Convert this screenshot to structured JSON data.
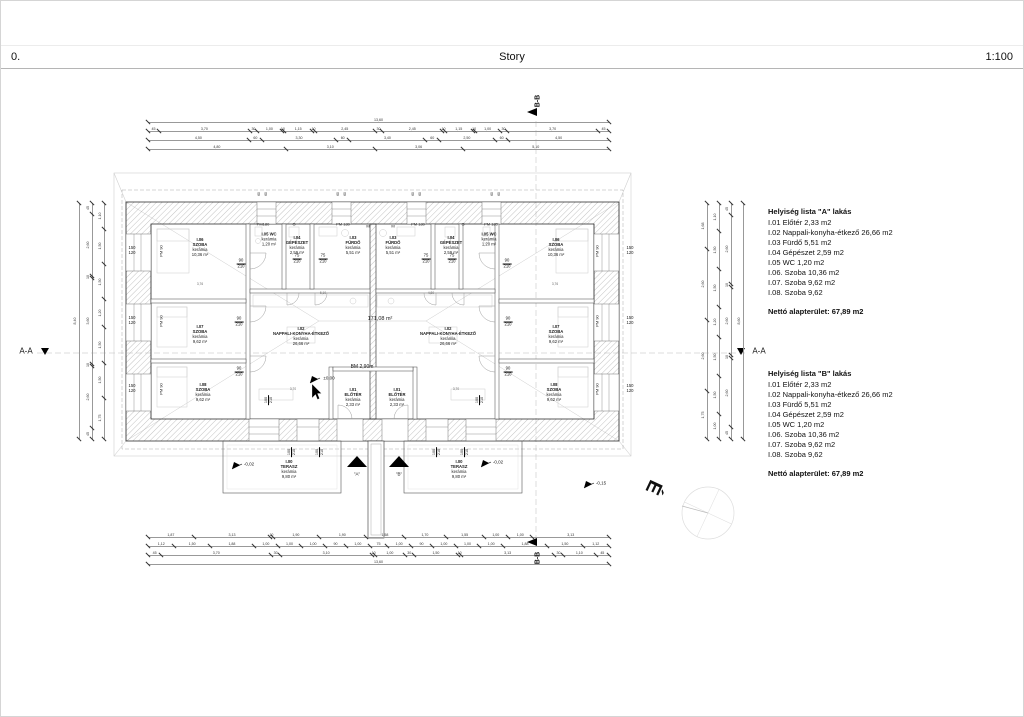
{
  "header": {
    "left": "0.",
    "center": "Story",
    "right": "1:100"
  },
  "section_markers": {
    "aa": "A-A",
    "bb": "B-B",
    "entrance_a": "\"A\"",
    "entrance_b": "\"B\"",
    "north": "É"
  },
  "room_lists": {
    "a": {
      "title": "Helyiség lista \"A\" lakás",
      "items": [
        "I.01 Előtér 2,33 m2",
        "I.02 Nappali-konyha-étkező 26,66 m2",
        "I.03 Fürdő 5,51 m2",
        "I.04 Gépészet 2,59 m2",
        "I.05 WC 1,20 m2",
        "I.06. Szoba 10,36 m2",
        "I.07. Szoba 9,62 m2",
        "I.08. Szoba 9,62"
      ],
      "total": "Nettó alapterület: 67,89 m2"
    },
    "b": {
      "title": "Helyiség lista \"B\" lakás",
      "items": [
        "I.01 Előtér 2,33 m2",
        "I.02 Nappali-konyha-étkező 26,66 m2",
        "I.03 Fürdő 5,51 m2",
        "I.04 Gépészet 2,59 m2",
        "I.05 WC 1,20 m2",
        "I.06. Szoba 10,36 m2",
        "I.07. Szoba 9,62 m2",
        "I.08. Szoba 9,62"
      ],
      "total": "Nettó alapterület: 67,89 m2"
    }
  },
  "plan": {
    "labels": [
      {
        "t": "I.06\nSZOBA\nkerámia\n10,36 m²",
        "x": 199,
        "y": 247,
        "hb": 2
      },
      {
        "t": "I.07\nSZOBA\nkerámia\n9,62 m²",
        "x": 199,
        "y": 334,
        "hb": 2
      },
      {
        "t": "I.08\nSZOBA\nkerámia\n9,62 m²",
        "x": 202,
        "y": 392,
        "hb": 2
      },
      {
        "t": "I.05 WC\nkerámia\n1,20 m²",
        "x": 268,
        "y": 239,
        "hb": 1
      },
      {
        "t": "I.04\nGÉPÉSZET\nkerámia\n2,59 m²",
        "x": 296,
        "y": 245,
        "hb": 2
      },
      {
        "t": "I.03\nFÜRDŐ\nkerámia\n5,51 m²",
        "x": 352,
        "y": 245,
        "hb": 2
      },
      {
        "t": "I.02\nNAPPALI-KONYHA-ÉTKEZŐ\nkerámia\n26,66 m²",
        "x": 300,
        "y": 336,
        "hb": 2
      },
      {
        "t": "I.01\nELŐTÉR\nkerámia\n2,33 m²",
        "x": 352,
        "y": 397,
        "hb": 2
      },
      {
        "t": "I.00\nTERASZ\nkerámia\n9,80 m²",
        "x": 288,
        "y": 469,
        "hb": 2
      },
      {
        "t": "I.03\nFÜRDŐ\nkerámia\n5,51 m²",
        "x": 392,
        "y": 245,
        "hb": 2
      },
      {
        "t": "I.04\nGÉPÉSZET\nkerámia\n2,59 m²",
        "x": 450,
        "y": 245,
        "hb": 2
      },
      {
        "t": "I.05 WC\nkerámia\n1,20 m²",
        "x": 488,
        "y": 239,
        "hb": 1
      },
      {
        "t": "I.06\nSZOBA\nkerámia\n10,36 m²",
        "x": 555,
        "y": 247,
        "hb": 2
      },
      {
        "t": "I.02\nNAPPALI-KONYHA-ÉTKEZŐ\nkerámia\n26,66 m²",
        "x": 447,
        "y": 336,
        "hb": 2
      },
      {
        "t": "I.07\nSZOBA\nkerámia\n9,62 m²",
        "x": 555,
        "y": 334,
        "hb": 2
      },
      {
        "t": "I.08\nSZOBA\nkerámia\n9,62 m²",
        "x": 553,
        "y": 392,
        "hb": 2
      },
      {
        "t": "I.01\nELŐTÉR\nkerámia\n2,33 m²",
        "x": 396,
        "y": 397,
        "hb": 2
      },
      {
        "t": "I.00\nTERASZ\nkerámia\n9,80 m²",
        "x": 458,
        "y": 469,
        "hb": 2
      },
      {
        "t": "171,08 m²",
        "x": 379,
        "y": 318,
        "fs": 5.5
      },
      {
        "t": "BM 2,90m",
        "x": 361,
        "y": 367,
        "fs": 5
      },
      {
        "t": "±0,00",
        "x": 328,
        "y": 377,
        "fs": 4.5
      },
      {
        "t": "-0,02",
        "x": 248,
        "y": 463,
        "fs": 4.5
      },
      {
        "t": "-0,02",
        "x": 497,
        "y": 461,
        "fs": 4.5
      },
      {
        "t": "-0,15",
        "x": 600,
        "y": 482,
        "fs": 4.5
      },
      {
        "t": "150\n120",
        "x": 131,
        "y": 250
      },
      {
        "t": "150\n120",
        "x": 131,
        "y": 320
      },
      {
        "t": "150\n120",
        "x": 131,
        "y": 388
      },
      {
        "t": "150\n120",
        "x": 629,
        "y": 250
      },
      {
        "t": "150\n120",
        "x": 629,
        "y": 320
      },
      {
        "t": "150\n120",
        "x": 629,
        "y": 388
      },
      {
        "t": "PM 90",
        "x": 161,
        "y": 250,
        "fs": 4,
        "rot": -90
      },
      {
        "t": "PM 90",
        "x": 161,
        "y": 320,
        "fs": 4,
        "rot": -90
      },
      {
        "t": "PM 90",
        "x": 161,
        "y": 388,
        "fs": 4,
        "rot": -90
      },
      {
        "t": "PM 90",
        "x": 597,
        "y": 250,
        "fs": 4,
        "rot": -90
      },
      {
        "t": "PM 90",
        "x": 597,
        "y": 320,
        "fs": 4,
        "rot": -90
      },
      {
        "t": "PM 90",
        "x": 597,
        "y": 388,
        "fs": 4,
        "rot": -90
      },
      {
        "t": "PM180",
        "x": 262,
        "y": 224,
        "fs": 4
      },
      {
        "t": "G",
        "x": 293,
        "y": 224,
        "fs": 4
      },
      {
        "t": "PM 180",
        "x": 342,
        "y": 224,
        "fs": 4
      },
      {
        "t": "M",
        "x": 367,
        "y": 226,
        "fs": 4
      },
      {
        "t": "M",
        "x": 392,
        "y": 226,
        "fs": 4
      },
      {
        "t": "PM 180",
        "x": 417,
        "y": 224,
        "fs": 4
      },
      {
        "t": "G",
        "x": 462,
        "y": 224,
        "fs": 4
      },
      {
        "t": "PM 180",
        "x": 490,
        "y": 224,
        "fs": 4
      },
      {
        "t": "60",
        "x": 259,
        "y": 193,
        "fs": 3.2,
        "rot": -90
      },
      {
        "t": "60",
        "x": 266,
        "y": 193,
        "fs": 3.2,
        "rot": -90
      },
      {
        "t": "60",
        "x": 338,
        "y": 193,
        "fs": 3.2,
        "rot": -90
      },
      {
        "t": "60",
        "x": 345,
        "y": 193,
        "fs": 3.2,
        "rot": -90
      },
      {
        "t": "60",
        "x": 413,
        "y": 193,
        "fs": 3.2,
        "rot": -90
      },
      {
        "t": "60",
        "x": 420,
        "y": 193,
        "fs": 3.2,
        "rot": -90
      },
      {
        "t": "60",
        "x": 492,
        "y": 193,
        "fs": 3.2,
        "rot": -90
      },
      {
        "t": "60",
        "x": 499,
        "y": 193,
        "fs": 3.2,
        "rot": -90
      },
      {
        "t": "90\n210",
        "x": 240,
        "y": 263,
        "u": true
      },
      {
        "t": "90\n210",
        "x": 238,
        "y": 321,
        "u": true
      },
      {
        "t": "90\n210",
        "x": 238,
        "y": 371,
        "u": true
      },
      {
        "t": "90\n210",
        "x": 506,
        "y": 263,
        "u": true
      },
      {
        "t": "90\n210",
        "x": 507,
        "y": 321,
        "u": true
      },
      {
        "t": "90\n210",
        "x": 507,
        "y": 371,
        "u": true
      },
      {
        "t": "75\n210",
        "x": 296,
        "y": 258,
        "u": true
      },
      {
        "t": "75\n210",
        "x": 322,
        "y": 258,
        "u": true
      },
      {
        "t": "75\n210",
        "x": 425,
        "y": 258,
        "u": true
      },
      {
        "t": "75\n210",
        "x": 451,
        "y": 258,
        "u": true
      },
      {
        "t": "100\n210",
        "x": 268,
        "y": 399,
        "fs": 3.8,
        "rot": -90,
        "u": true
      },
      {
        "t": "100\n210",
        "x": 479,
        "y": 399,
        "fs": 3.8,
        "rot": -90,
        "u": true
      },
      {
        "t": "100\n210",
        "x": 291,
        "y": 451,
        "fs": 3.8,
        "rot": -90,
        "u": true
      },
      {
        "t": "100\n210",
        "x": 319,
        "y": 451,
        "fs": 3.8,
        "rot": -90,
        "u": true
      },
      {
        "t": "100\n210",
        "x": 436,
        "y": 451,
        "fs": 3.8,
        "rot": -90,
        "u": true
      },
      {
        "t": "100\n210",
        "x": 464,
        "y": 451,
        "fs": 3.8,
        "rot": -90,
        "u": true
      },
      {
        "t": "3,76",
        "x": 199,
        "y": 284,
        "fs": 3.2,
        "c": 1
      },
      {
        "t": "3,76",
        "x": 554,
        "y": 284,
        "fs": 3.2,
        "c": 1
      },
      {
        "t": "3,70",
        "x": 292,
        "y": 389,
        "fs": 3.2,
        "c": 1
      },
      {
        "t": "3,70",
        "x": 455,
        "y": 389,
        "fs": 3.2,
        "c": 1
      },
      {
        "t": "5,10",
        "x": 322,
        "y": 293,
        "fs": 3.2,
        "c": 1
      },
      {
        "t": "4,80",
        "x": 430,
        "y": 293,
        "fs": 3.2,
        "c": 1
      }
    ],
    "chains": [
      {
        "o": "h",
        "x": 147,
        "y": 121,
        "len": 461,
        "vals": [
          "13,60"
        ],
        "total": true
      },
      {
        "o": "h",
        "x": 147,
        "y": 130,
        "len": 461,
        "vals": [
          "45",
          "3,70",
          "30",
          "1,00",
          "10",
          "1,15",
          "10",
          "2,45",
          "30",
          "2,45",
          "10",
          "1,15",
          "10",
          "1,00",
          "30",
          "3,70",
          "45"
        ]
      },
      {
        "o": "h",
        "x": 147,
        "y": 139,
        "len": 461,
        "vals": [
          "4,50",
          "60",
          "3,30",
          "60",
          "3,40",
          "60",
          "2,50",
          "60",
          "4,50"
        ]
      },
      {
        "o": "h",
        "x": 147,
        "y": 148,
        "len": 461,
        "vals": [
          "4,80",
          "3,10",
          "3,06",
          "5,10"
        ]
      },
      {
        "o": "h",
        "x": 147,
        "y": 536,
        "len": 461,
        "vals": [
          "1,87",
          "3,13",
          "10",
          "1,90",
          "1,90",
          "1,58",
          "1,70",
          "1,55",
          "1,00",
          "1,00",
          "3,13"
        ]
      },
      {
        "o": "h",
        "x": 147,
        "y": 545,
        "len": 461,
        "vals": [
          "1,12",
          "1,50",
          "1,88",
          "1,00",
          "1,00",
          "1,00",
          "90",
          "1,00",
          "75",
          "1,00",
          "90",
          "1,00",
          "1,00",
          "1,00",
          "1,88",
          "1,50",
          "1,12"
        ]
      },
      {
        "o": "h",
        "x": 147,
        "y": 554,
        "len": 461,
        "vals": [
          "45",
          "3,70",
          "30",
          "3,10",
          "10",
          "1,00",
          "30",
          "1,50",
          "10",
          "3,13",
          "30",
          "1,10",
          "45"
        ]
      },
      {
        "o": "h",
        "x": 147,
        "y": 563,
        "len": 461,
        "vals": [
          "13,60"
        ],
        "total": true
      },
      {
        "o": "v",
        "x": 78,
        "y": 202,
        "len": 236,
        "vals": [
          "8,40"
        ],
        "total": true
      },
      {
        "o": "v",
        "x": 91,
        "y": 202,
        "len": 236,
        "vals": [
          "45",
          "2,60",
          "10",
          "3,60",
          "10",
          "2,60",
          "45"
        ]
      },
      {
        "o": "v",
        "x": 103,
        "y": 202,
        "len": 236,
        "vals": [
          "1,10",
          "1,50",
          "1,50",
          "1,20",
          "1,50",
          "1,50",
          "1,75"
        ]
      },
      {
        "o": "v",
        "x": 706,
        "y": 202,
        "len": 236,
        "vals": [
          "1,68",
          "2,60",
          "2,60",
          "1,75"
        ]
      },
      {
        "o": "v",
        "x": 718,
        "y": 202,
        "len": 236,
        "vals": [
          "1,10",
          "1,50",
          "1,50",
          "1,20",
          "1,50",
          "1,50",
          "1,00"
        ]
      },
      {
        "o": "v",
        "x": 730,
        "y": 202,
        "len": 236,
        "vals": [
          "45",
          "2,60",
          "10",
          "2,60",
          "10",
          "2,60",
          "45"
        ]
      },
      {
        "o": "v",
        "x": 742,
        "y": 202,
        "len": 236,
        "vals": [
          "8,60"
        ],
        "total": true
      }
    ]
  }
}
